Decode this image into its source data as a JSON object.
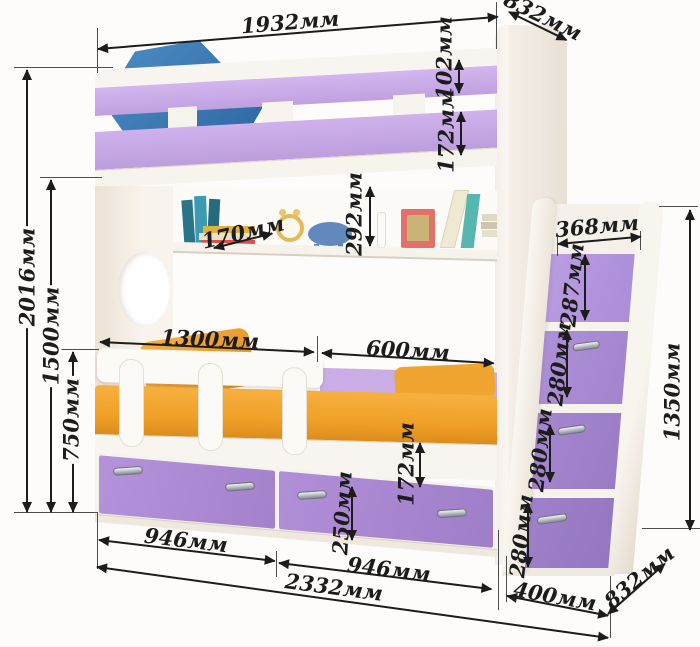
{
  "diagram": {
    "subject": "bunk-bed-with-drawers-and-step-ladder",
    "unit": "мм",
    "annotations": {
      "top_width": "1932мм",
      "top_depth": "832мм",
      "top_rail_height": "102мм",
      "upper_guard_height": "172мм",
      "total_height": "2016мм",
      "upper_bed_height": "1500мм",
      "lower_rail_height": "750мм",
      "shelf_depth": "170мм",
      "shelf_opening_height": "292мм",
      "lower_guard_length": "1300мм",
      "lower_opening_length": "600мм",
      "ladder_top_width": "368мм",
      "ladder_step_1": "287мм",
      "ladder_step_2": "280мм",
      "ladder_step_3": "280мм",
      "ladder_step_4": "280мм",
      "ladder_height": "1350мм",
      "base_frame_height": "172мм",
      "drawer_height": "250мм",
      "drawer_left_width": "946мм",
      "drawer_right_width": "946мм",
      "total_length": "2332мм",
      "ladder_base_width": "400мм",
      "bottom_depth": "832мм"
    },
    "colors": {
      "ink": "#1c1c1c",
      "rail": "#c7a9e6",
      "drawer": "#ab8ed3",
      "step": "#a98ed6",
      "mattress": "#f2a435",
      "pillow": "#3b7cb8",
      "white1": "#f7f3ee",
      "cream": "#efe6da"
    }
  }
}
